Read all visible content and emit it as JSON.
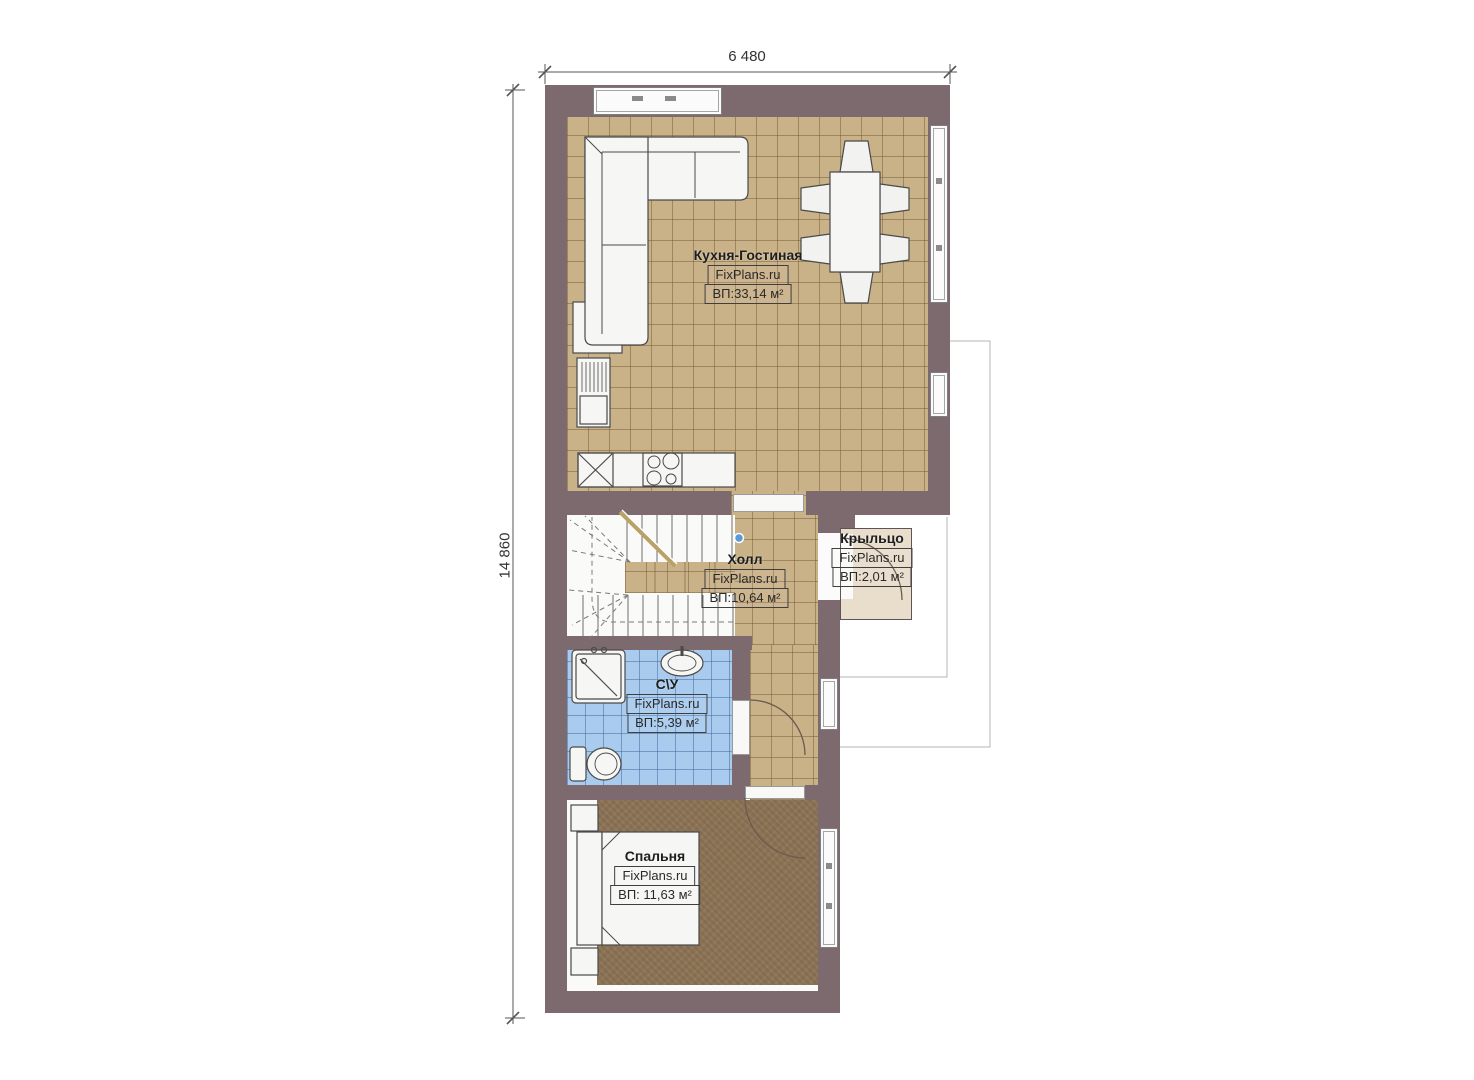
{
  "plan": {
    "dimensions": {
      "width_label": "6 480",
      "height_label": "14 860"
    },
    "rooms": [
      {
        "id": "kitchen-living",
        "name": "Кухня-Гостиная",
        "watermark": "FixPlans.ru",
        "area": "ВП:33,14 м²"
      },
      {
        "id": "hall",
        "name": "Холл",
        "watermark": "FixPlans.ru",
        "area": "ВП:10,64 м²"
      },
      {
        "id": "porch",
        "name": "Крыльцо",
        "watermark": "FixPlans.ru",
        "area": "ВП:2,01 м²"
      },
      {
        "id": "bathroom",
        "name": "С\\У",
        "watermark": "FixPlans.ru",
        "area": "ВП:5,39 м²"
      },
      {
        "id": "bedroom",
        "name": "Спальня",
        "watermark": "FixPlans.ru",
        "area": "ВП: 11,63 м²"
      }
    ],
    "colors": {
      "wall": "#7c6a6e",
      "tile_floor": "#c9b188",
      "bath_floor": "#a9cbee",
      "carpet_floor": "#8c7355",
      "porch_floor": "#e9decb",
      "selection_handle": "#5b9bd5"
    }
  }
}
